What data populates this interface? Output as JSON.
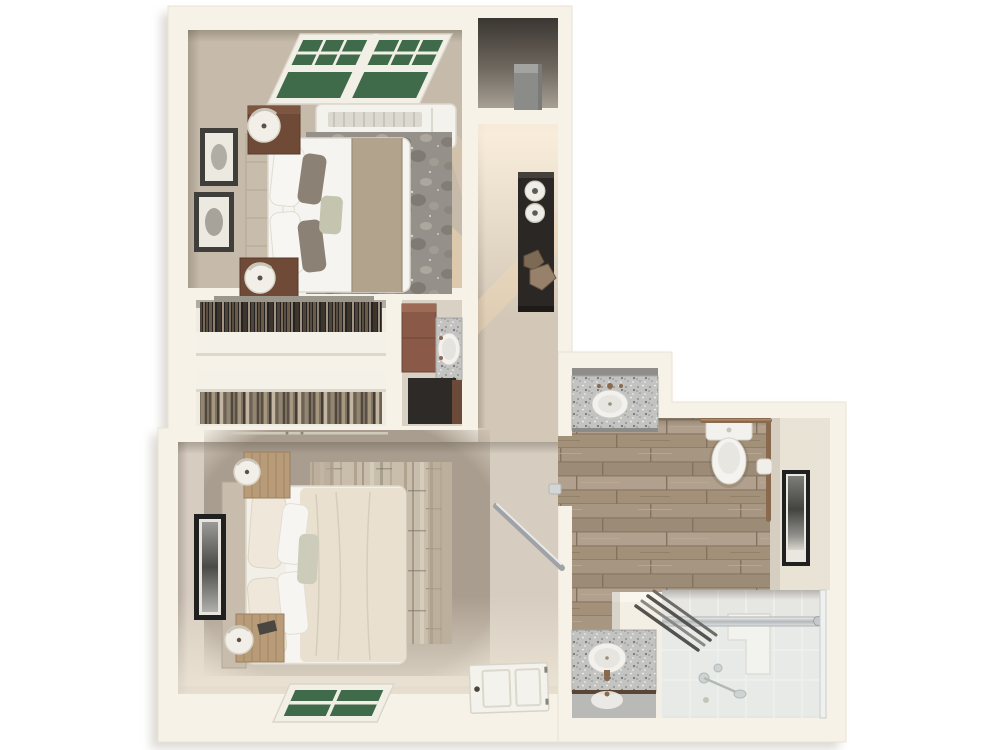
{
  "meta": {
    "type": "3d-floor-plan",
    "description": "Top-down 3D rendering of an apartment floor plan: bedroom with window and PTAC unit (top left), storage closet (top right), hallway with console table, two walk-in closets with vanity nook (middle), second bedroom with window and entry door (bottom left), and bathroom with two vanities, toilet, grab bars and walk-in shower (right).",
    "background": "#ffffff"
  },
  "palette": {
    "wall": "#f6f2e7",
    "wall_shadow": "#b3ada1",
    "bedroom1_carpet": "#c6bbaa",
    "bedroom2_carpet": "#a99d8f",
    "bedroom2_light": "#d6cdc0",
    "hall_carpet": "#d3c8b7",
    "closet_floor": "#efebe1",
    "nook_floor": "#d9d2c4",
    "shelf": "#f4f1e9",
    "window_green": "#3f6b4b",
    "window_frame": "#f2efe6",
    "runner": "#b2a38c",
    "headboard": "#c8bdac",
    "duvet": "#e9e0d0",
    "linen_white": "#f5f4f0",
    "nightstand_dark": "#6f4a37",
    "nightstand_light": "#b89b79",
    "console_dark": "#2b2724",
    "vanity_cabinet": "#8a5948",
    "dark_cabinet": "#2e2a27",
    "bronze": "#8a6a4e",
    "chrome": "#c6c9cb",
    "rail_silver": "#9fa3a5",
    "tile": "#e6e6e3",
    "wall_face": "#e9e3d6",
    "frame_black": "#202020"
  },
  "scene": {
    "rooms": [
      {
        "id": "bedroom-1",
        "position": "top-left",
        "furniture": [
          "double-window",
          "ptac-ac-unit",
          "bed",
          "headboard",
          "bed-runner",
          "pillows",
          "area-rug",
          "nightstand",
          "table-lamp",
          "nightstand",
          "table-lamp",
          "wall-art",
          "wall-art"
        ]
      },
      {
        "id": "storage-closet",
        "position": "top-right",
        "furniture": [
          "storage-box"
        ]
      },
      {
        "id": "hallway",
        "position": "right",
        "furniture": [
          "console-table",
          "vase",
          "vase",
          "decor-stones"
        ]
      },
      {
        "id": "walk-in-closet-1",
        "position": "middle",
        "furniture": [
          "hanging-clothes",
          "closet-shelf"
        ]
      },
      {
        "id": "walk-in-closet-2",
        "position": "middle",
        "furniture": [
          "closet-shelf",
          "hanging-clothes"
        ]
      },
      {
        "id": "vanity-nook",
        "position": "middle-right",
        "furniture": [
          "cabinet",
          "granite-counter",
          "sink",
          "dark-cabinet"
        ]
      },
      {
        "id": "bedroom-2",
        "position": "bottom-left",
        "furniture": [
          "bed",
          "headboard",
          "duvet",
          "pillows",
          "area-rug",
          "nightstand",
          "table-lamp",
          "nightstand",
          "table-lamp",
          "wall-art",
          "window",
          "interior-door",
          "grab-rail"
        ]
      },
      {
        "id": "bathroom",
        "position": "bottom-right",
        "furniture": [
          "vanity-sink-top",
          "mirror",
          "toilet",
          "grab-bar",
          "toilet-paper-holder",
          "wall-art",
          "walk-in-shower",
          "shower-glass",
          "shower-bench",
          "shower-fixtures",
          "towel-bars",
          "half-wall",
          "vanity-sink-bottom",
          "mirror"
        ]
      }
    ]
  }
}
